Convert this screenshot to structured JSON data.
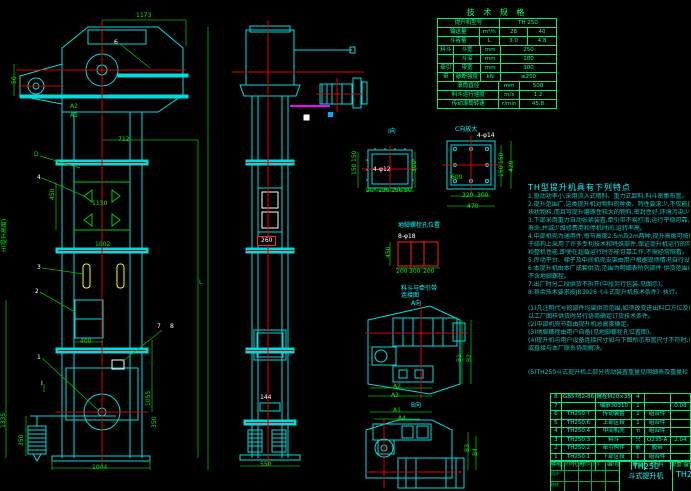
{
  "drawing": {
    "canvas_name": "TH250斗式提升机总图",
    "section_mark": "I"
  },
  "spec_table": {
    "title": "技 术 规 格",
    "rows": [
      [
        [
          "提升机型号",
          62
        ],
        [
          "TH 250",
          57
        ]
      ],
      [
        [
          "输送量",
          42
        ],
        [
          "m³/h",
          20
        ],
        [
          "28",
          28
        ],
        [
          "40",
          29
        ]
      ],
      [
        [
          "斗容量",
          42
        ],
        [
          "L",
          20
        ],
        [
          "3.0",
          28
        ],
        [
          "4.8",
          29
        ]
      ],
      [
        [
          "料斗",
          16
        ],
        [
          "斗宽",
          26
        ],
        [
          "mm",
          20
        ],
        [
          "250",
          57
        ]
      ],
      [
        [
          "",
          16
        ],
        [
          "斗深",
          26
        ],
        [
          "mm",
          20
        ],
        [
          "180",
          57
        ]
      ],
      [
        [
          "牵引",
          16
        ],
        [
          "带宽",
          26
        ],
        [
          "mm",
          20
        ],
        [
          "300",
          57
        ]
      ],
      [
        [
          "带",
          16
        ],
        [
          "破断强度",
          26
        ],
        [
          "kN",
          20
        ],
        [
          "≥250",
          57
        ]
      ],
      [
        [
          "滚筒直径",
          62
        ],
        [
          "mm",
          20
        ],
        [
          "500",
          37
        ]
      ],
      [
        [
          "料斗运行速度",
          62
        ],
        [
          "m/s",
          20
        ],
        [
          "1.2",
          37
        ]
      ],
      [
        [
          "传动滚筒转速",
          62
        ],
        [
          "r/min",
          20
        ],
        [
          "45.8",
          37
        ]
      ]
    ]
  },
  "notes": {
    "title": "TH型提升机具有下列特点",
    "lines": [
      "1.驱动功率小,采用流入式喂料、重力式卸料,料斗密集布置。",
      "2.提升范围广,这类提升机对物料的种类、特性要求少,不仅能提升一般粉状、小",
      "  块状物料,而且可提升磨琢性较大的物料,密封性好,环境污染少。",
      "3.下部采用重力自动张紧装置,牵引带不易打滑,运行平稳可靠,大大延长了使用",
      "  寿命,并减少维修费用和停机时间,运转率高。",
      "4.中部机壳为通用件,每节高度2.5m及2m两种,提升高度可按用户需要选取,由",
      "  于结构上采用了许多专利技术和特殊部件,保证提升机运行的可靠性、工作寿命",
      "  和整机性能,即使在超载运行时亦能可靠工作,不需经常照看。",
      "5.传动平台、梯子及中间机壳支架由用户根据现场情况自行设计制造。",
      "6.本提升机由本厂成套供货,范围为明细表所列部件          供货范围以订货合同为准,",
      "  不含地脚螺栓。",
      "7.出厂时分二段供货不拆开(中段另行包装,见图示)。",
      "8.其余技术要求按JB3926《斗式提升机技术条件》执行。",
      "",
      "(1)凡注明代号的部件均属供货范围,如须改变进出料口方位及尺寸请在订货时注明,",
      "  以工厂图样供货时另行协商确定订货技术条件。",
      "(2)中部机壳节数由提升机总高度确定。",
      "(3)地脚螺栓由用户自备(见地脚螺栓孔位置图)。",
      "(4)提升机与用户设备连接尺寸如与下图所示布置尺寸不符时,请用户自行调整,",
      "  或直接与本厂联系协商解决。",
      "",
      "",
      "(5)TH250斗式提升机上部分传动装置重量见明细表及重量栏 A=40。",
      ""
    ]
  },
  "bom": {
    "col_widths": [
      10,
      35,
      36,
      12,
      26,
      20
    ],
    "rows": [
      [
        "8",
        "GB5782-86",
        "螺栓M20×35",
        "4",
        "",
        ""
      ],
      [
        "7",
        "",
        "轴承30310",
        "1",
        "",
        "0.08"
      ],
      [
        "6",
        "TH250.7",
        "传动装置",
        "1",
        "组合件",
        ""
      ],
      [
        "5",
        "TH250.6",
        "上部区段",
        "1",
        "组合件",
        ""
      ],
      [
        "4",
        "TH250.4",
        "中间机壳",
        "节",
        "组合件",
        ""
      ],
      [
        "3",
        "TH250.3",
        "料斗",
        "只",
        "Q235-A",
        "2.04"
      ],
      [
        "2",
        "TH250.2",
        "牵引构件",
        "条",
        "胶带",
        ""
      ],
      [
        "1",
        "TH250.1",
        "下部区段",
        "1",
        "组合件",
        ""
      ]
    ],
    "header": [
      "件号",
      "代 号",
      "名 称",
      "数量",
      "材 料",
      "单重 备注"
    ]
  },
  "title_block": {
    "model": "TH250",
    "name": "斗式提升机",
    "drawing_code": "TH250",
    "mini_rows": [
      [
        "标记",
        "处数",
        "更改文件号",
        "签字",
        "日期"
      ],
      [
        "设计",
        "",
        "",
        "",
        ""
      ],
      [
        "校核",
        "",
        "",
        "",
        ""
      ]
    ]
  },
  "labels": [
    [
      "6",
      114,
      40,
      "w"
    ],
    [
      "1173",
      136,
      13,
      "g"
    ],
    [
      "50",
      12,
      84,
      "g",
      1
    ],
    [
      "A2",
      70,
      104,
      "g"
    ],
    [
      "A1",
      70,
      113,
      "g"
    ],
    [
      "712",
      118,
      137,
      "g"
    ],
    [
      "D",
      34,
      152,
      "g"
    ],
    [
      "4",
      37,
      175,
      "w"
    ],
    [
      "450",
      50,
      200,
      "g",
      1
    ],
    [
      "1130",
      92,
      201,
      "g"
    ],
    [
      "1002",
      95,
      242,
      "g"
    ],
    [
      "3",
      37,
      265,
      "w"
    ],
    [
      "2",
      35,
      289,
      "w"
    ],
    [
      "H(提升高度)",
      2,
      252,
      "g",
      1
    ],
    [
      "400",
      80,
      339,
      "g"
    ],
    [
      "7",
      157,
      324,
      "w"
    ],
    [
      "8",
      170,
      324,
      "w"
    ],
    [
      "1",
      37,
      355,
      "w"
    ],
    [
      "I",
      41,
      381,
      "w"
    ],
    [
      "1335",
      1,
      428,
      "g",
      1
    ],
    [
      "350",
      19,
      446,
      "g",
      1
    ],
    [
      "1055",
      146,
      406,
      "g",
      1
    ],
    [
      "350",
      152,
      428,
      "g",
      1
    ],
    [
      "1044",
      92,
      465,
      "g"
    ],
    [
      "L",
      199,
      280,
      "g"
    ],
    [
      "260",
      257,
      236,
      "w",
      0,
      1
    ],
    [
      "144",
      260,
      395,
      "w"
    ],
    [
      "550",
      260,
      462,
      "g"
    ],
    [
      "I向",
      388,
      129,
      "c"
    ],
    [
      "150",
      352,
      162,
      "g",
      1
    ],
    [
      "150",
      352,
      175,
      "g",
      1
    ],
    [
      "300",
      412,
      172,
      "g",
      1
    ],
    [
      "4-φ12",
      373,
      167,
      "w"
    ],
    [
      "90",
      366,
      188,
      "g"
    ],
    [
      "156",
      378,
      188,
      "g"
    ],
    [
      "156",
      391,
      188,
      "g"
    ],
    [
      "90",
      404,
      188,
      "g"
    ],
    [
      "C向放大",
      455,
      127,
      "c"
    ],
    [
      "4-φ14",
      477,
      133,
      "w"
    ],
    [
      "600",
      451,
      175,
      "g"
    ],
    [
      "150",
      499,
      164,
      "g",
      1
    ],
    [
      "150",
      499,
      177,
      "g",
      1
    ],
    [
      "420",
      509,
      172,
      "g",
      1
    ],
    [
      "320",
      462,
      193,
      "g"
    ],
    [
      "300",
      477,
      193,
      "g"
    ],
    [
      "470",
      467,
      204,
      "g"
    ],
    [
      "地脚螺栓孔位置",
      398,
      223,
      "c"
    ],
    [
      "8-φ18",
      398,
      234,
      "w"
    ],
    [
      "450",
      386,
      258,
      "g",
      1
    ],
    [
      "200",
      396,
      269,
      "g"
    ],
    [
      "300",
      409,
      269,
      "g"
    ],
    [
      "200",
      423,
      269,
      "g"
    ],
    [
      "料斗与牵引带",
      401,
      286,
      "c"
    ],
    [
      "连接图",
      401,
      293,
      "c"
    ],
    [
      "A向",
      411,
      301,
      "c"
    ],
    [
      "B1",
      457,
      362,
      "g",
      1
    ],
    [
      "B2",
      467,
      362,
      "g",
      1
    ],
    [
      "A2",
      393,
      384,
      "g"
    ],
    [
      "A3",
      391,
      393,
      "g"
    ],
    [
      "B向",
      411,
      403,
      "c"
    ],
    [
      "A1",
      393,
      408,
      "g"
    ],
    [
      "A4",
      398,
      416,
      "g"
    ],
    [
      "B3",
      465,
      452,
      "g",
      1
    ],
    [
      "B4",
      473,
      456,
      "g",
      1
    ]
  ]
}
